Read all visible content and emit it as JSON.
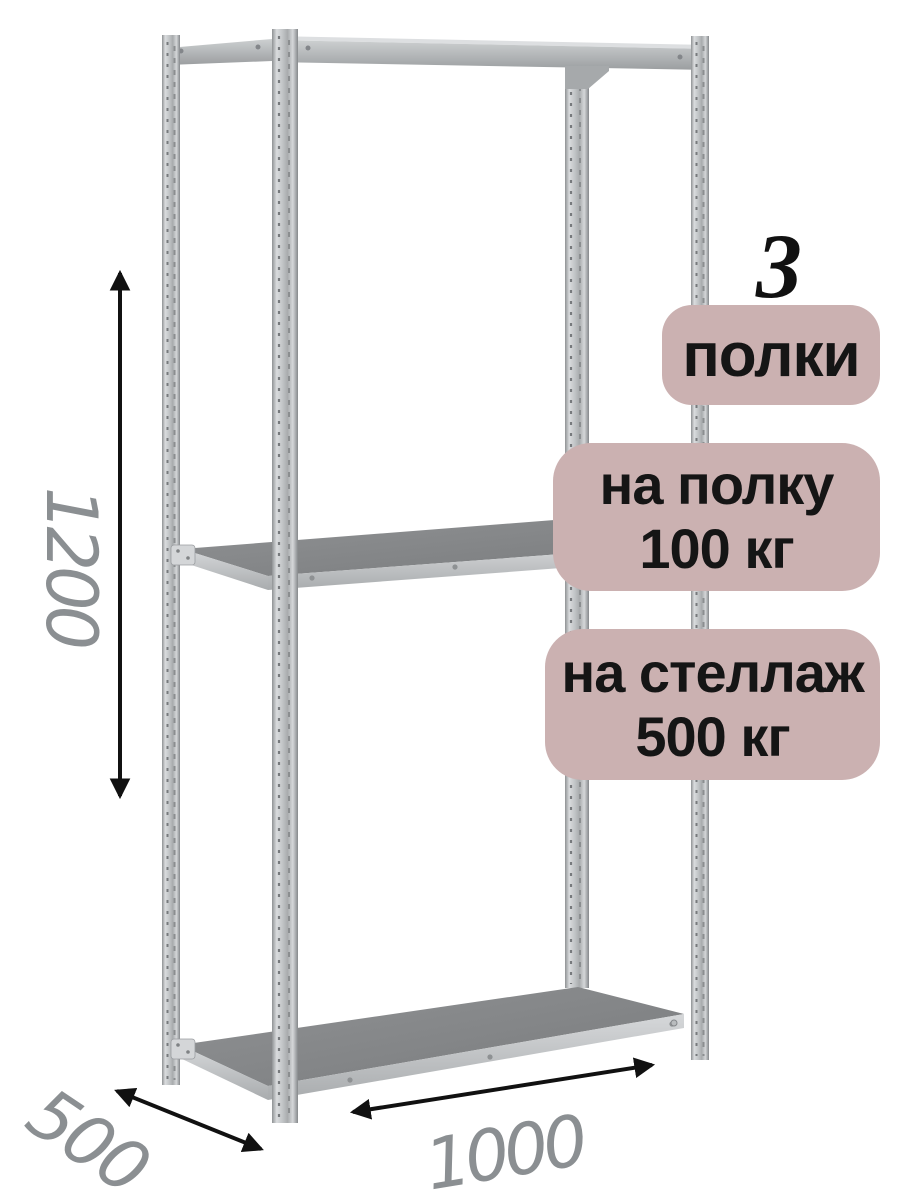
{
  "badges": {
    "count": {
      "number": "3",
      "label": "полки"
    },
    "per_shelf": {
      "line1": "на полку",
      "line2": "100 кг"
    },
    "per_rack": {
      "line1": "на стеллаж",
      "line2": "500 кг"
    }
  },
  "dimensions": {
    "height_mm": "1200",
    "depth_mm": "500",
    "width_mm": "1000"
  },
  "colors": {
    "background": "#ffffff",
    "badge_background": "#cbb1b1",
    "badge_text": "#151515",
    "count_number_text": "#111111",
    "dimension_text": "#8b8f92",
    "arrow": "#111111",
    "metal_light": "#d8dadc",
    "metal_dark": "#85888b",
    "shelf_top_face": "#848688"
  }
}
